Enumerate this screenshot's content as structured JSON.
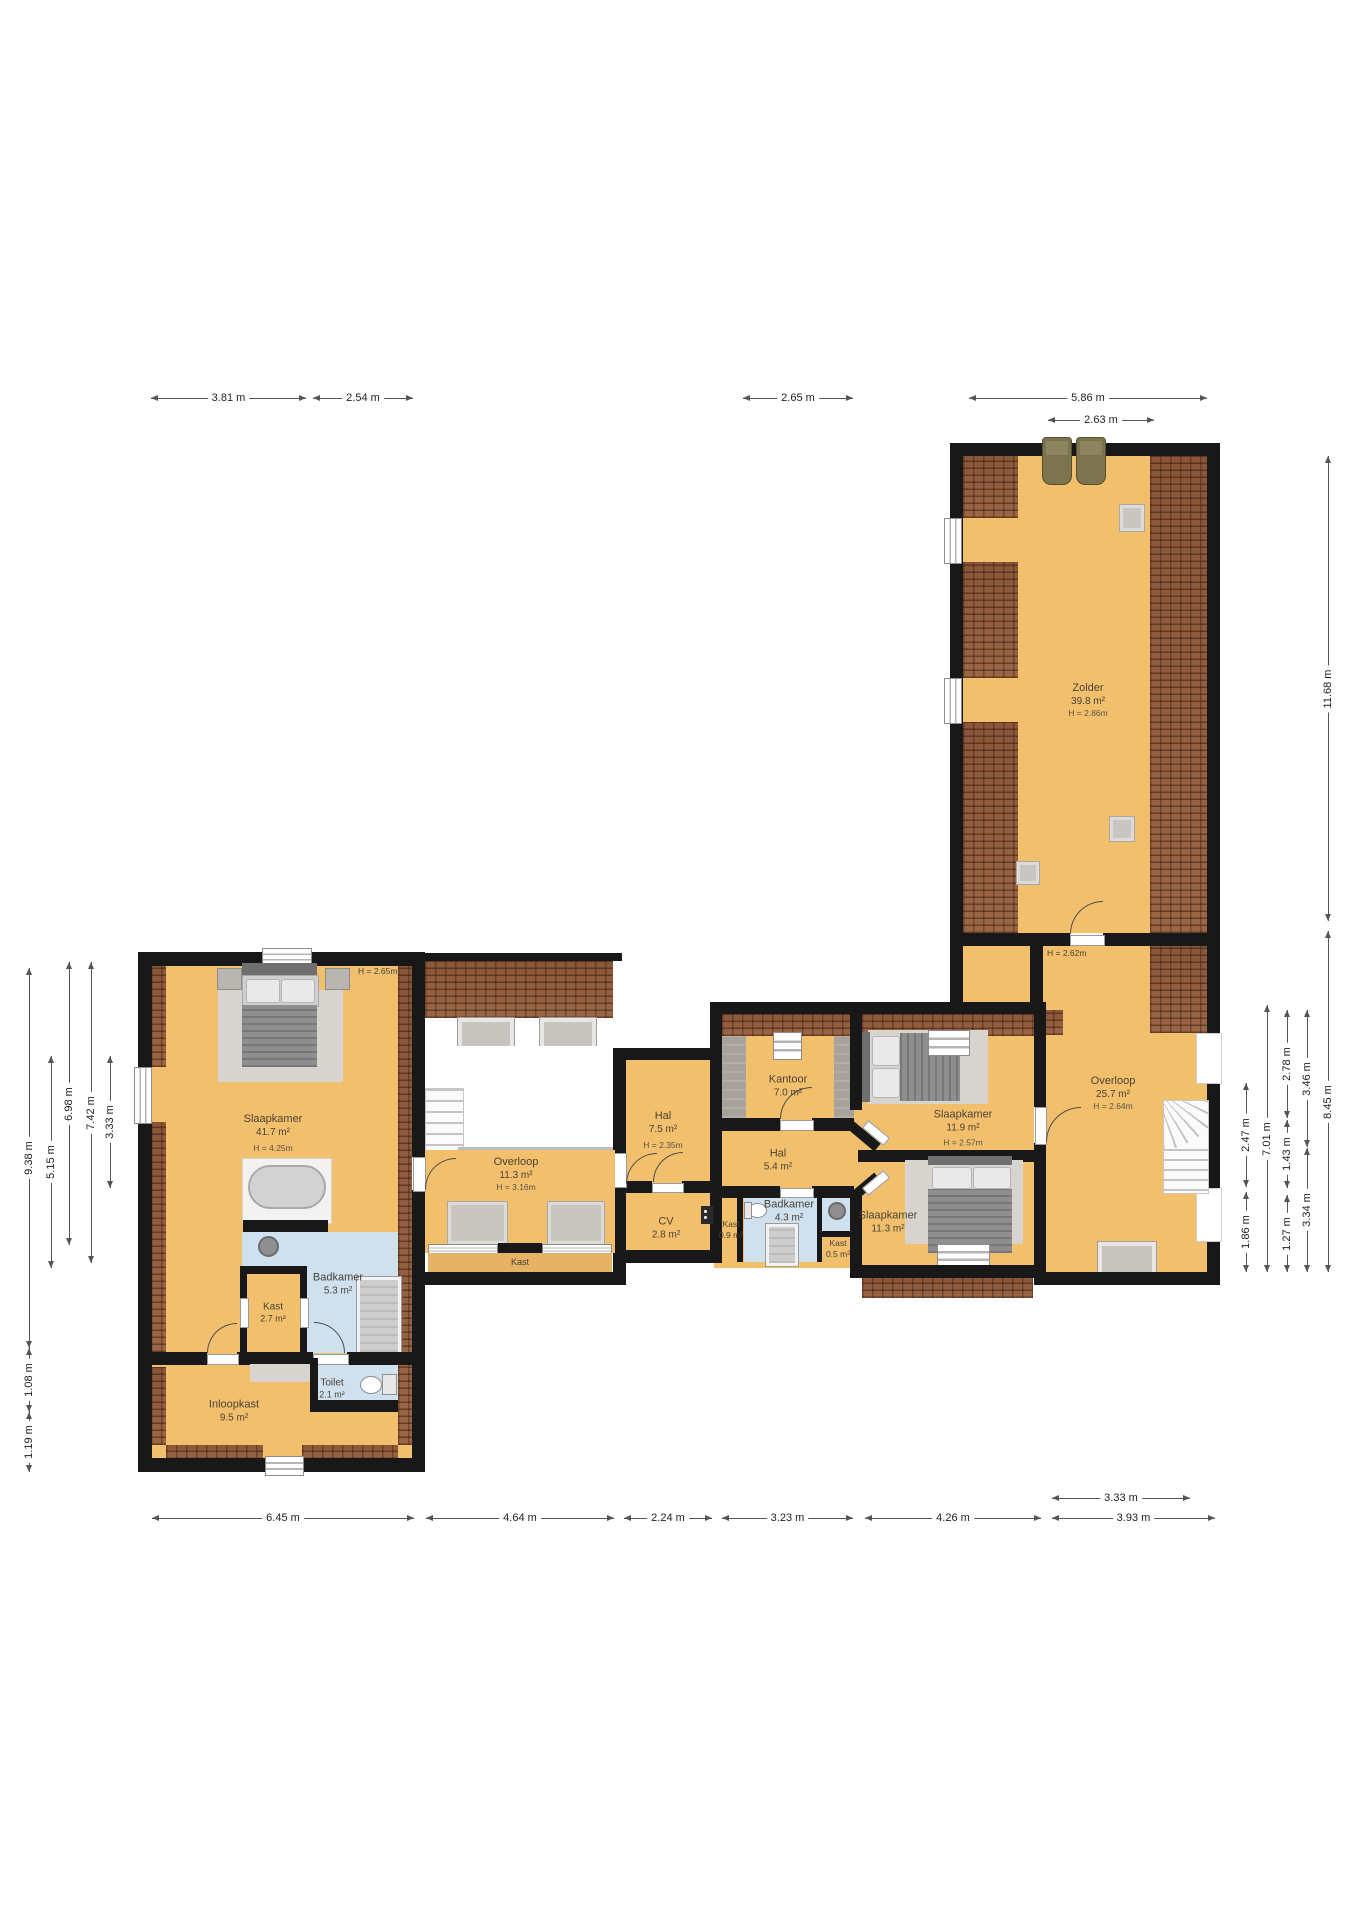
{
  "title": "Floor plan - verdieping",
  "rooms": {
    "zolder": {
      "name": "Zolder",
      "area": "39.8 m²",
      "height": "H = 2.86m"
    },
    "slaapkamer_groot": {
      "name": "Slaapkamer",
      "area": "41.7 m²",
      "height": "H = 4.25m"
    },
    "overloop_links": {
      "name": "Overloop",
      "area": "11.3 m²",
      "height": "H = 3.16m"
    },
    "hal_75": {
      "name": "Hal",
      "area": "7.5 m²",
      "height": "H = 2.35m"
    },
    "kantoor": {
      "name": "Kantoor",
      "area": "7.0 m²"
    },
    "hal_54": {
      "name": "Hal",
      "area": "5.4 m²"
    },
    "cv": {
      "name": "CV",
      "area": "2.8 m²"
    },
    "kast_09": {
      "name": "Kast",
      "area": "0.9 m²"
    },
    "badkamer_43": {
      "name": "Badkamer",
      "area": "4.3 m²"
    },
    "kast_05": {
      "name": "Kast",
      "area": "0.5 m²"
    },
    "slaapkamer_119": {
      "name": "Slaapkamer",
      "area": "11.9 m²",
      "height": "H = 2.57m"
    },
    "slaapkamer_113": {
      "name": "Slaapkamer",
      "area": "11.3 m²"
    },
    "overloop_rechts": {
      "name": "Overloop",
      "area": "25.7 m²",
      "height": "H = 2.64m"
    },
    "badkamer_53": {
      "name": "Badkamer",
      "area": "5.3 m²"
    },
    "kast_27": {
      "name": "Kast",
      "area": "2.7 m²"
    },
    "toilet": {
      "name": "Toilet",
      "area": "2.1 m²"
    },
    "inloopkast": {
      "name": "Inloopkast",
      "area": "9.5 m²"
    },
    "kast_wand": {
      "name": "Kast"
    }
  },
  "annotations": {
    "h_265": "H = 2.65m",
    "h_262": "H = 2.62m"
  },
  "measurements": {
    "top": [
      {
        "label": "3.81 m"
      },
      {
        "label": "2.54 m"
      },
      {
        "label": "2.65 m"
      },
      {
        "label": "5.86 m"
      },
      {
        "label": "2.63 m"
      }
    ],
    "bottom": [
      {
        "label": "6.45 m"
      },
      {
        "label": "4.64 m"
      },
      {
        "label": "2.24 m"
      },
      {
        "label": "3.23 m"
      },
      {
        "label": "4.26 m"
      },
      {
        "label": "3.93 m"
      },
      {
        "label": "3.33 m"
      }
    ],
    "left": [
      {
        "label": "9.38 m"
      },
      {
        "label": "1.08 m"
      },
      {
        "label": "1.19 m"
      },
      {
        "label": "5.15 m"
      },
      {
        "label": "6.98 m"
      },
      {
        "label": "7.42 m"
      },
      {
        "label": "3.33 m"
      }
    ],
    "right": [
      {
        "label": "11.68 m"
      },
      {
        "label": "8.45 m"
      },
      {
        "label": "2.47 m"
      },
      {
        "label": "1.86 m"
      },
      {
        "label": "7.01 m"
      },
      {
        "label": "2.78 m"
      },
      {
        "label": "1.43 m"
      },
      {
        "label": "1.27 m"
      },
      {
        "label": "3.46 m"
      },
      {
        "label": "3.34 m"
      }
    ]
  },
  "colors": {
    "floor": "#f2c06c",
    "roof": "#935f41",
    "bathroom": "#cfe0ee",
    "wall": "#181818"
  }
}
